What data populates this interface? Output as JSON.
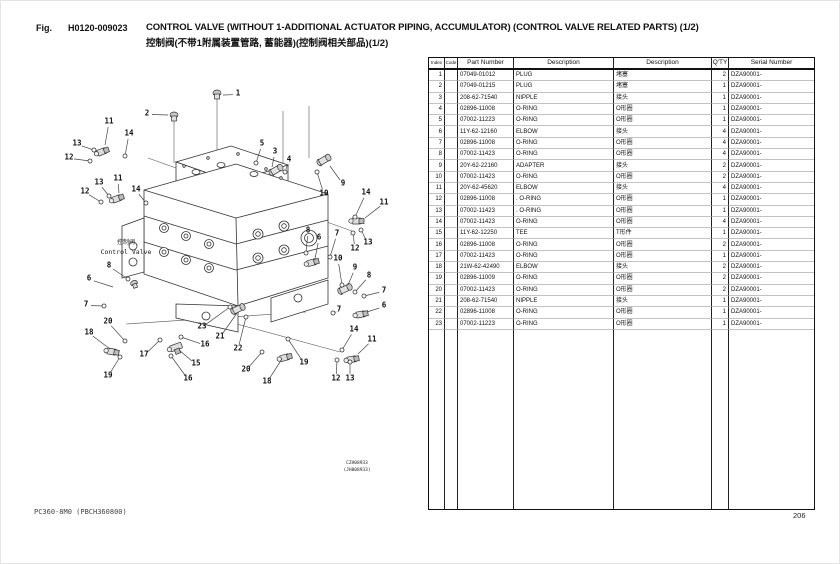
{
  "page": {
    "fig_label": "Fig.",
    "fig_number": "H0120-009023",
    "title_en": "CONTROL VALVE (WITHOUT 1-ADDITIONAL ACTUATOR PIPING, ACCUMULATOR) (CONTROL VALVE RELATED PARTS) (1/2)",
    "title_cn": "控制阀(不带1附属装置管路, 蓄能器)(控制阀相关部品)(1/2)",
    "footer_left": "PC360-8M0 (PBCH360800)",
    "page_number": "206"
  },
  "diagram": {
    "label_cn": "控制阀",
    "label_en": "Control Valve",
    "drawing_code": "CZH08933",
    "drawing_code_alt": "(JH008933)",
    "callouts": [
      {
        "n": "1",
        "x": 212,
        "y": 27,
        "ex": 197,
        "ey": 29,
        "o": 0
      },
      {
        "n": "2",
        "x": 121,
        "y": 47,
        "ex": 142,
        "ey": 49,
        "o": 0
      },
      {
        "n": "11",
        "x": 83,
        "y": 55,
        "ex": 79,
        "ey": 79,
        "o": 0
      },
      {
        "n": "14",
        "x": 103,
        "y": 67,
        "ex": 99,
        "ey": 90,
        "o": 1
      },
      {
        "n": "13",
        "x": 51,
        "y": 77,
        "ex": 68,
        "ey": 84,
        "o": 1
      },
      {
        "n": "12",
        "x": 43,
        "y": 91,
        "ex": 64,
        "ey": 95,
        "o": 1
      },
      {
        "n": "11",
        "x": 92,
        "y": 112,
        "ex": 93,
        "ey": 127,
        "o": 0
      },
      {
        "n": "13",
        "x": 73,
        "y": 116,
        "ex": 83,
        "ey": 130,
        "o": 1
      },
      {
        "n": "12",
        "x": 59,
        "y": 125,
        "ex": 75,
        "ey": 136,
        "o": 1
      },
      {
        "n": "14",
        "x": 110,
        "y": 123,
        "ex": 120,
        "ey": 137,
        "o": 1
      },
      {
        "n": "5",
        "x": 236,
        "y": 77,
        "ex": 230,
        "ey": 97,
        "o": 1
      },
      {
        "n": "3",
        "x": 249,
        "y": 85,
        "ex": 246,
        "ey": 101,
        "o": 0
      },
      {
        "n": "4",
        "x": 263,
        "y": 93,
        "ex": 259,
        "ey": 106,
        "o": 1
      },
      {
        "n": "9",
        "x": 317,
        "y": 117,
        "ex": 304,
        "ey": 100,
        "o": 0
      },
      {
        "n": "10",
        "x": 298,
        "y": 127,
        "ex": 291,
        "ey": 106,
        "o": 1
      },
      {
        "n": "14",
        "x": 340,
        "y": 126,
        "ex": 329,
        "ey": 151,
        "o": 1
      },
      {
        "n": "11",
        "x": 358,
        "y": 136,
        "ex": 339,
        "ey": 152,
        "o": 0
      },
      {
        "n": "8",
        "x": 282,
        "y": 164,
        "ex": 280,
        "ey": 187,
        "o": 1
      },
      {
        "n": "6",
        "x": 293,
        "y": 171,
        "ex": 289,
        "ey": 193,
        "o": 0
      },
      {
        "n": "7",
        "x": 311,
        "y": 167,
        "ex": 304,
        "ey": 191,
        "o": 1
      },
      {
        "n": "13",
        "x": 342,
        "y": 176,
        "ex": 335,
        "ey": 164,
        "o": 1
      },
      {
        "n": "12",
        "x": 329,
        "y": 182,
        "ex": 327,
        "ey": 167,
        "o": 1
      },
      {
        "n": "10",
        "x": 312,
        "y": 192,
        "ex": 316,
        "ey": 219,
        "o": 1
      },
      {
        "n": "9",
        "x": 329,
        "y": 201,
        "ex": 322,
        "ey": 219,
        "o": 0
      },
      {
        "n": "8",
        "x": 343,
        "y": 209,
        "ex": 329,
        "ey": 226,
        "o": 1
      },
      {
        "n": "7",
        "x": 358,
        "y": 224,
        "ex": 338,
        "ey": 230,
        "o": 1
      },
      {
        "n": "6",
        "x": 358,
        "y": 239,
        "ex": 341,
        "ey": 246,
        "o": 0
      },
      {
        "n": "7",
        "x": 313,
        "y": 243,
        "ex": 307,
        "ey": 247,
        "o": 1
      },
      {
        "n": "8",
        "x": 83,
        "y": 199,
        "ex": 102,
        "ey": 213,
        "o": 1
      },
      {
        "n": "6",
        "x": 63,
        "y": 212,
        "ex": 87,
        "ey": 221,
        "o": 0
      },
      {
        "n": "7",
        "x": 60,
        "y": 238,
        "ex": 78,
        "ey": 240,
        "o": 1
      },
      {
        "n": "20",
        "x": 82,
        "y": 255,
        "ex": 99,
        "ey": 275,
        "o": 1
      },
      {
        "n": "18",
        "x": 63,
        "y": 266,
        "ex": 84,
        "ey": 283,
        "o": 0
      },
      {
        "n": "19",
        "x": 82,
        "y": 309,
        "ex": 94,
        "ey": 291,
        "o": 1
      },
      {
        "n": "17",
        "x": 118,
        "y": 288,
        "ex": 134,
        "ey": 274,
        "o": 1
      },
      {
        "n": "16",
        "x": 179,
        "y": 278,
        "ex": 155,
        "ey": 271,
        "o": 1
      },
      {
        "n": "15",
        "x": 170,
        "y": 297,
        "ex": 153,
        "ey": 284,
        "o": 0
      },
      {
        "n": "16",
        "x": 162,
        "y": 312,
        "ex": 145,
        "ey": 290,
        "o": 1
      },
      {
        "n": "23",
        "x": 176,
        "y": 260,
        "ex": 204,
        "ey": 241,
        "o": 1
      },
      {
        "n": "21",
        "x": 194,
        "y": 270,
        "ex": 211,
        "ey": 247,
        "o": 0
      },
      {
        "n": "22",
        "x": 212,
        "y": 282,
        "ex": 220,
        "ey": 251,
        "o": 1
      },
      {
        "n": "20",
        "x": 220,
        "y": 303,
        "ex": 236,
        "ey": 286,
        "o": 1
      },
      {
        "n": "18",
        "x": 241,
        "y": 315,
        "ex": 256,
        "ey": 293,
        "o": 0
      },
      {
        "n": "19",
        "x": 278,
        "y": 296,
        "ex": 262,
        "ey": 273,
        "o": 1
      },
      {
        "n": "12",
        "x": 310,
        "y": 312,
        "ex": 311,
        "ey": 294,
        "o": 1
      },
      {
        "n": "13",
        "x": 324,
        "y": 312,
        "ex": 324,
        "ey": 296,
        "o": 1
      },
      {
        "n": "14",
        "x": 328,
        "y": 263,
        "ex": 316,
        "ey": 284,
        "o": 1
      },
      {
        "n": "11",
        "x": 346,
        "y": 273,
        "ex": 332,
        "ey": 288,
        "o": 0
      }
    ]
  },
  "table": {
    "headers": [
      "Index",
      "Code",
      "Part Number",
      "Description",
      "Description",
      "Q'TY",
      "Serial Number"
    ],
    "rows": [
      {
        "index": "1",
        "code": "",
        "part_number": "07049-01012",
        "description_en": "PLUG",
        "description_cn": "堵塞",
        "qty": "2",
        "serial": "DZA90001-"
      },
      {
        "index": "2",
        "code": "",
        "part_number": "07049-01215",
        "description_en": "PLUG",
        "description_cn": "堵塞",
        "qty": "1",
        "serial": "DZA90001-"
      },
      {
        "index": "3",
        "code": "",
        "part_number": "208-62-71540",
        "description_en": "NIPPLE",
        "description_cn": "接头",
        "qty": "1",
        "serial": "DZA90001-"
      },
      {
        "index": "4",
        "code": "",
        "part_number": "02896-11008",
        "description_en": "O-RING",
        "description_cn": "O形圈",
        "qty": "1",
        "serial": "DZA90001-"
      },
      {
        "index": "5",
        "code": "",
        "part_number": "07002-11223",
        "description_en": "O-RING",
        "description_cn": "O形圈",
        "qty": "1",
        "serial": "DZA90001-"
      },
      {
        "index": "6",
        "code": "",
        "part_number": "11Y-62-12160",
        "description_en": "ELBOW",
        "description_cn": "接头",
        "qty": "4",
        "serial": "DZA90001-"
      },
      {
        "index": "7",
        "code": "",
        "part_number": "02896-11008",
        "description_en": "O-RING",
        "description_cn": "O形圈",
        "qty": "4",
        "serial": "DZA90001-"
      },
      {
        "index": "8",
        "code": "",
        "part_number": "07002-11423",
        "description_en": "O-RING",
        "description_cn": "O形圈",
        "qty": "4",
        "serial": "DZA90001-"
      },
      {
        "index": "9",
        "code": "",
        "part_number": "20Y-62-22160",
        "description_en": "ADAPTER",
        "description_cn": "接头",
        "qty": "2",
        "serial": "DZA90001-"
      },
      {
        "index": "10",
        "code": "",
        "part_number": "07002-11423",
        "description_en": "O-RING",
        "description_cn": "O形圈",
        "qty": "2",
        "serial": "DZA90001-"
      },
      {
        "index": "11",
        "code": "",
        "part_number": "20Y-62-45620",
        "description_en": "ELBOW",
        "description_cn": "接头",
        "qty": "4",
        "serial": "DZA90001-"
      },
      {
        "index": "12",
        "code": "",
        "part_number": "02896-11008",
        "description_en": ". O-RING",
        "description_cn": "O形圈",
        "qty": "1",
        "serial": "DZA90001-"
      },
      {
        "index": "13",
        "code": "",
        "part_number": "07002-11423",
        "description_en": ". O-RING",
        "description_cn": "O形圈",
        "qty": "1",
        "serial": "DZA90001-"
      },
      {
        "index": "14",
        "code": "",
        "part_number": "07002-11423",
        "description_en": "O-RING",
        "description_cn": "O形圈",
        "qty": "4",
        "serial": "DZA90001-"
      },
      {
        "index": "15",
        "code": "",
        "part_number": "11Y-62-12250",
        "description_en": "TEE",
        "description_cn": "T形件",
        "qty": "1",
        "serial": "DZA90001-"
      },
      {
        "index": "16",
        "code": "",
        "part_number": "02896-11008",
        "description_en": "O-RING",
        "description_cn": "O形圈",
        "qty": "2",
        "serial": "DZA90001-"
      },
      {
        "index": "17",
        "code": "",
        "part_number": "07002-11423",
        "description_en": "O-RING",
        "description_cn": "O形圈",
        "qty": "1",
        "serial": "DZA90001-"
      },
      {
        "index": "18",
        "code": "",
        "part_number": "21W-62-42490",
        "description_en": "ELBOW",
        "description_cn": "接头",
        "qty": "2",
        "serial": "DZA90001-"
      },
      {
        "index": "19",
        "code": "",
        "part_number": "02896-11009",
        "description_en": "O-RING",
        "description_cn": "O形圈",
        "qty": "2",
        "serial": "DZA90001-"
      },
      {
        "index": "20",
        "code": "",
        "part_number": "07002-11423",
        "description_en": "O-RING",
        "description_cn": "O形圈",
        "qty": "2",
        "serial": "DZA90001-"
      },
      {
        "index": "21",
        "code": "",
        "part_number": "208-62-71540",
        "description_en": "NIPPLE",
        "description_cn": "接头",
        "qty": "1",
        "serial": "DZA90001-"
      },
      {
        "index": "22",
        "code": "",
        "part_number": "02896-11008",
        "description_en": "O-RING",
        "description_cn": "O形圈",
        "qty": "1",
        "serial": "DZA90001-"
      },
      {
        "index": "23",
        "code": "",
        "part_number": "07002-11223",
        "description_en": "O-RING",
        "description_cn": "O形圈",
        "qty": "1",
        "serial": "DZA90001-"
      }
    ]
  }
}
